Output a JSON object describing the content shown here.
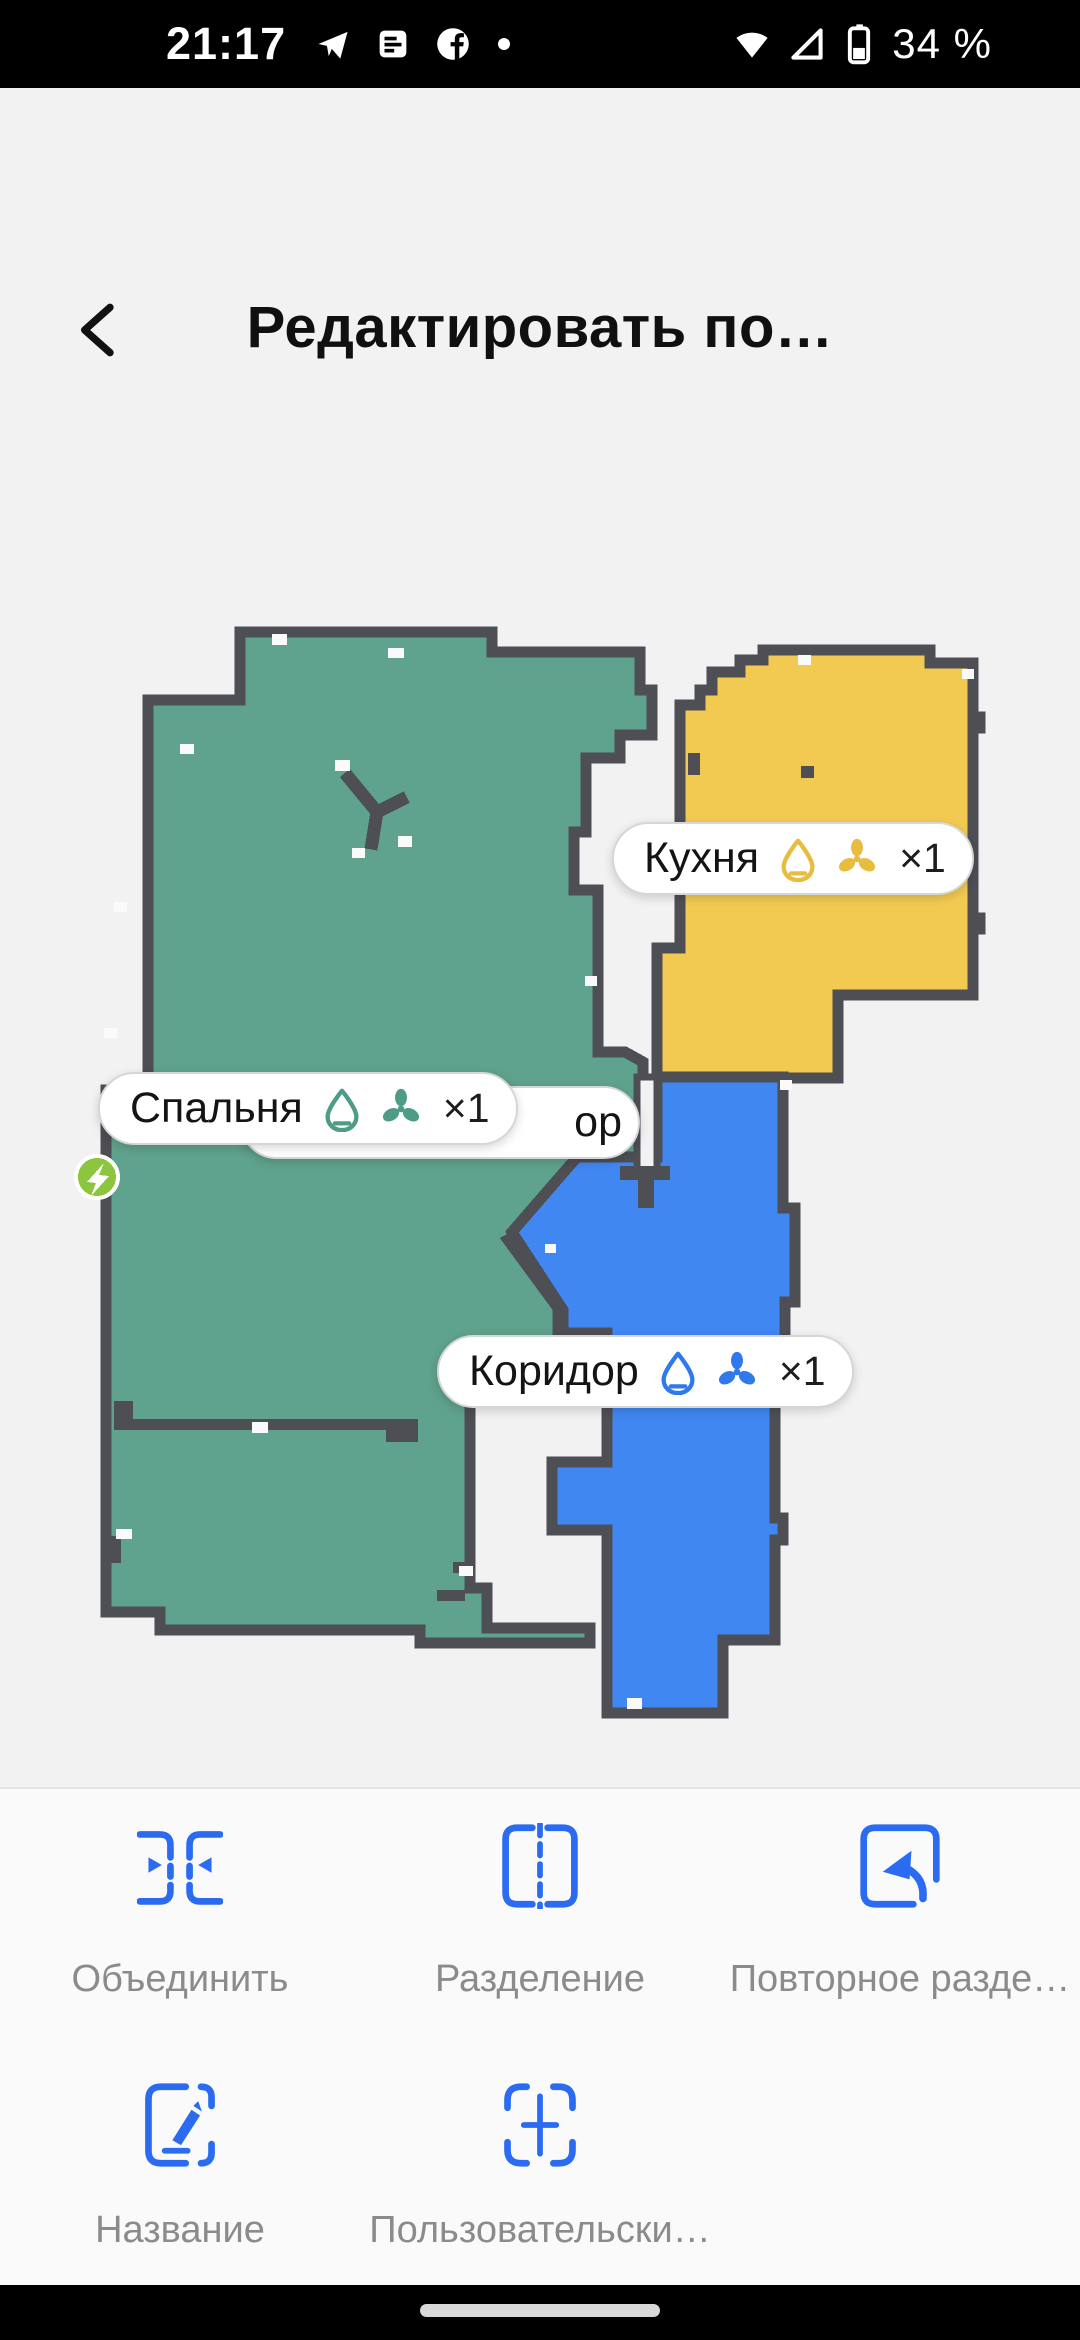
{
  "colors": {
    "wall": "#4E4E55",
    "background": "#F2F2F3",
    "room_bedroom": "#5FA28D",
    "room_kitchen": "#F2CA52",
    "room_corridor": "#4187F2",
    "icon_bedroom": "#4E9C85",
    "icon_kitchen": "#E8BD3F",
    "icon_corridor": "#2F78EE",
    "accent": "#2A6BF2",
    "dock": "#8CC63E",
    "speck": "#FAFAFA",
    "label_gray": "#8B8B8B"
  },
  "status_bar": {
    "time": "21:17",
    "battery_percent": "34 %"
  },
  "header": {
    "title": "Редактировать по…"
  },
  "map": {
    "pills": {
      "kitchen": {
        "label": "Кухня",
        "count": "×1"
      },
      "bedroom": {
        "label": "Спальня",
        "count": "×1"
      },
      "corridor": {
        "label": "Коридор",
        "count": "×1"
      },
      "hidden_fragment": {
        "label": "ор"
      }
    }
  },
  "toolbar": {
    "row1": [
      {
        "label": "Объединить"
      },
      {
        "label": "Разделение"
      },
      {
        "label": "Повторное разде…"
      }
    ],
    "row2": [
      {
        "label": "Название"
      },
      {
        "label": "Пользовательски…"
      }
    ]
  }
}
